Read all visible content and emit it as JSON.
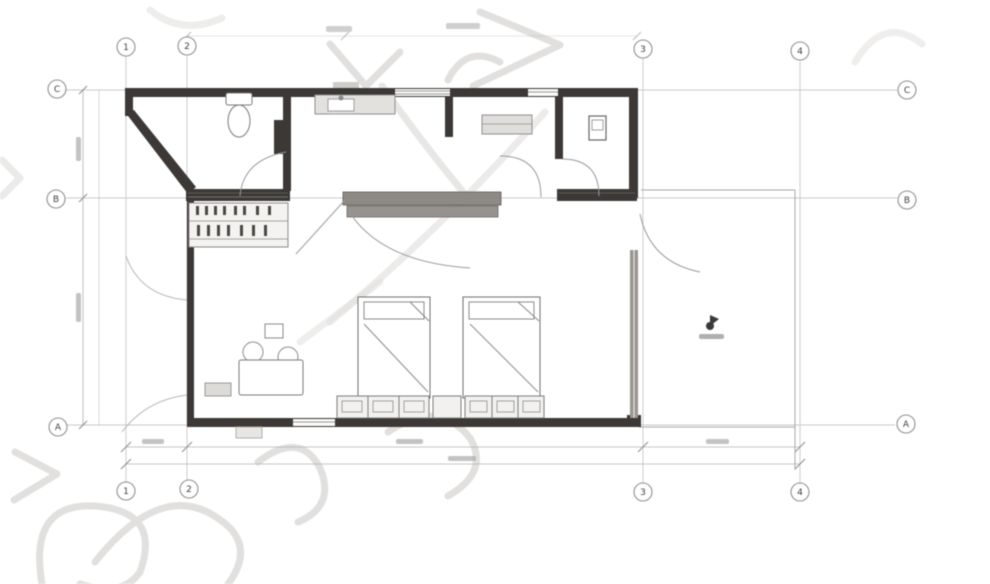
{
  "grid": {
    "cols": [
      "1",
      "2",
      "3",
      "4"
    ],
    "rows": [
      "C",
      "B",
      "A"
    ]
  },
  "colors": {
    "paper": "#ffffff",
    "wall": "#3b3835",
    "fixture_line": "#7a7a7a",
    "grid_line": "#c2c2c2",
    "dimension_line": "#b3b3b3",
    "counter_fill": "#8d8984",
    "watermark": "#dedddb"
  },
  "dimensions": {
    "labels_legible": false
  },
  "icons": {
    "level_marker": "flag-dot"
  },
  "fixtures": [
    "toilet",
    "sink-counter",
    "kitchen-cabinet",
    "long-counter",
    "desk",
    "electrical-panel",
    "table-with-chairs",
    "bed-1",
    "bed-2",
    "drawer-bench-1",
    "drawer-bench-2",
    "window-wall",
    "terrace",
    "level-marker"
  ]
}
